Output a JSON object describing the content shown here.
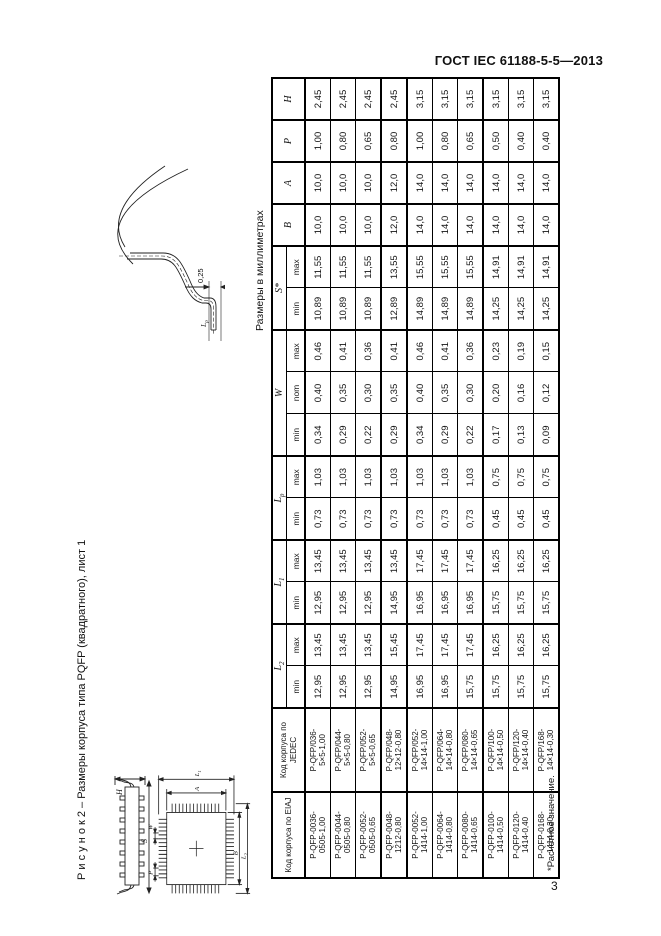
{
  "page": {
    "header": "ГОСТ IEC 61188-5-5—2013",
    "number": "3"
  },
  "figure": {
    "caption": "Р и с у н о к  2  –  Размеры корпуса типа PQFP (квадратного), лист 1",
    "units_note": "Размеры в миллиметрах",
    "footnote": "*Расчетное значение.",
    "labels": {
      "height": "H",
      "span_side": "S",
      "body_height": "A",
      "body_width": "B",
      "pitch": "P",
      "lead_width": "W",
      "lead_span_v": {
        "base": "L",
        "sub": "1"
      },
      "lead_span_h": {
        "base": "L",
        "sub": "2"
      },
      "gauge_offset": "0,25",
      "foot_length": {
        "base": "L",
        "sub": "p"
      }
    }
  },
  "table": {
    "header": {
      "eiaj": "Код корпуса по EIAJ",
      "jedec": "Код корпуса по JEDEC",
      "groups": [
        {
          "base": "L",
          "sub": "2"
        },
        {
          "base": "L",
          "sub": "1"
        },
        {
          "base": "L",
          "sub": "p"
        },
        {
          "base": "W",
          "sub": ""
        },
        {
          "base": "S*",
          "sub": ""
        },
        {
          "base": "B",
          "sub": ""
        },
        {
          "base": "A",
          "sub": ""
        },
        {
          "base": "P",
          "sub": ""
        },
        {
          "base": "H",
          "sub": ""
        }
      ],
      "sub_labels": [
        "min",
        "max",
        "min",
        "max",
        "min",
        "max",
        "min",
        "nom",
        "max",
        "min",
        "max"
      ]
    },
    "rows": [
      {
        "eiaj": [
          "P-QFP-0036-",
          "0505-1,00"
        ],
        "jedec": [
          "P-QFP/036-",
          "5×5-1,00"
        ],
        "values": [
          "12,95",
          "13,45",
          "12,95",
          "13,45",
          "0,73",
          "1,03",
          "0,34",
          "0,40",
          "0,46",
          "10,89",
          "11,55",
          "10,0",
          "10,0",
          "1,00",
          "2,45"
        ],
        "group_end": false
      },
      {
        "eiaj": [
          "P-QFP-0044-",
          "0505-0,80"
        ],
        "jedec": [
          "P-QFP/044-",
          "5×5-0,80"
        ],
        "values": [
          "12,95",
          "13,45",
          "12,95",
          "13,45",
          "0,73",
          "1,03",
          "0,29",
          "0,35",
          "0,41",
          "10,89",
          "11,55",
          "10,0",
          "10,0",
          "0,80",
          "2,45"
        ],
        "group_end": false
      },
      {
        "eiaj": [
          "P-QFP-0052-",
          "0505-0,65"
        ],
        "jedec": [
          "P-QFP/052-",
          "5×5-0,65"
        ],
        "values": [
          "12,95",
          "13,45",
          "12,95",
          "13,45",
          "0,73",
          "1,03",
          "0,22",
          "0,30",
          "0,36",
          "10,89",
          "11,55",
          "10,0",
          "10,0",
          "0,65",
          "2,45"
        ],
        "group_end": true
      },
      {
        "eiaj": [
          "P-QFP-0048-",
          "1212-0,80"
        ],
        "jedec": [
          "P-QFP/048-",
          "12×12-0,80"
        ],
        "values": [
          "14,95",
          "15,45",
          "14,95",
          "13,45",
          "0,73",
          "1,03",
          "0,29",
          "0,35",
          "0,41",
          "12,89",
          "13,55",
          "12,0",
          "12,0",
          "0,80",
          "2,45"
        ],
        "group_end": true
      },
      {
        "eiaj": [
          "P-QFP-0052-",
          "1414-1,00"
        ],
        "jedec": [
          "P-QFP/052-",
          "14×14-1,00"
        ],
        "values": [
          "16,95",
          "17,45",
          "16,95",
          "17,45",
          "0,73",
          "1,03",
          "0,34",
          "0,40",
          "0,46",
          "14,89",
          "15,55",
          "14,0",
          "14,0",
          "1,00",
          "3,15"
        ],
        "group_end": false
      },
      {
        "eiaj": [
          "P-QFP-0064-",
          "1414-0,80"
        ],
        "jedec": [
          "P-QFP/064-",
          "14×14-0,80"
        ],
        "values": [
          "16,95",
          "17,45",
          "16,95",
          "17,45",
          "0,73",
          "1,03",
          "0,29",
          "0,35",
          "0,41",
          "14,89",
          "15,55",
          "14,0",
          "14,0",
          "0,80",
          "3,15"
        ],
        "group_end": false
      },
      {
        "eiaj": [
          "P-QFP-0080-",
          "1414-0,65"
        ],
        "jedec": [
          "P-QFP/080-",
          "14×14-0,65"
        ],
        "values": [
          "15,75",
          "17,45",
          "16,95",
          "17,45",
          "0,73",
          "1,03",
          "0,22",
          "0,30",
          "0,36",
          "14,89",
          "15,55",
          "14,0",
          "14,0",
          "0,65",
          "3,15"
        ],
        "group_end": true
      },
      {
        "eiaj": [
          "P-QFP-0100-",
          "1414-0,50"
        ],
        "jedec": [
          "P-QFP/100-",
          "14×14-0,50"
        ],
        "values": [
          "15,75",
          "16,25",
          "15,75",
          "16,25",
          "0,45",
          "0,75",
          "0,17",
          "0,20",
          "0,23",
          "14,25",
          "14,91",
          "14,0",
          "14,0",
          "0,50",
          "3,15"
        ],
        "group_end": false
      },
      {
        "eiaj": [
          "P-QFP-0120-",
          "1414-0,40"
        ],
        "jedec": [
          "P-QFP/120-",
          "14×14-0,40"
        ],
        "values": [
          "15,75",
          "16,25",
          "15,75",
          "16,25",
          "0,45",
          "0,75",
          "0,13",
          "0,16",
          "0,19",
          "14,25",
          "14,91",
          "14,0",
          "14,0",
          "0,40",
          "3,15"
        ],
        "group_end": false
      },
      {
        "eiaj": [
          "P-QFP-0168-",
          "1414-0,30"
        ],
        "jedec": [
          "P-QFP/168-",
          "14×14-0,30"
        ],
        "values": [
          "15,75",
          "16,25",
          "15,75",
          "16,25",
          "0,45",
          "0,75",
          "0,09",
          "0,12",
          "0,15",
          "14,25",
          "14,91",
          "14,0",
          "14,0",
          "0,40",
          "3,15"
        ],
        "group_end": false
      }
    ]
  }
}
